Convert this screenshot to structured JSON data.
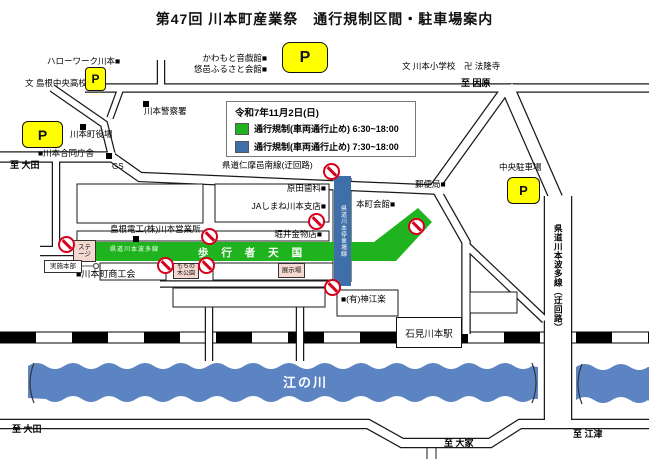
{
  "title": "第47回 川本町産業祭　通行規制区間・駐車場案内",
  "legend": {
    "date": "令和7年11月2日(日)",
    "items": [
      {
        "color": "#1fb41f",
        "label": "通行規制(車両通行止め) 6:30~18:00"
      },
      {
        "color": "#3f6fa8",
        "label": "通行規制(車両通行止め) 7:30~18:00"
      }
    ]
  },
  "green_zone": {
    "route_label": "県道川本波多線",
    "label": "歩 行 者 天 国"
  },
  "blue_road": {
    "label": "県道川本停車場線"
  },
  "bypass_road": {
    "label": "県道川本波多線（迂回路）"
  },
  "river": {
    "name": "江の川"
  },
  "station": {
    "name": "石見川本駅"
  },
  "boxes": [
    {
      "name": "stage-box",
      "text": "ステージ",
      "x": 73,
      "y": 240,
      "w": 23,
      "h": 22,
      "bg": "#f5d8cf",
      "fs": 6.5
    },
    {
      "name": "mochinoki-park-box",
      "text": "もちの木公園",
      "x": 173,
      "y": 263,
      "w": 26,
      "h": 16,
      "bg": "#f5d8cf",
      "fs": 6
    },
    {
      "name": "exhibition-box",
      "text": "展示場",
      "x": 278,
      "y": 263,
      "w": 27,
      "h": 15,
      "bg": "#f5d8cf",
      "fs": 6.5
    },
    {
      "name": "headquarters-box",
      "text": "実施本部",
      "x": 44,
      "y": 260,
      "w": 38,
      "h": 13,
      "bg": "#ffffff",
      "fs": 6.5
    }
  ],
  "parkings": [
    {
      "name": "parking-hellowork",
      "label": "P",
      "x": 85,
      "y": 67,
      "w": 21,
      "h": 24,
      "fs": 12,
      "r": 4
    },
    {
      "name": "parking-townhall",
      "label": "P",
      "x": 22,
      "y": 121,
      "w": 41,
      "h": 27,
      "fs": 14,
      "r": 6
    },
    {
      "name": "parking-kaikan",
      "label": "P",
      "x": 282,
      "y": 42,
      "w": 46,
      "h": 31,
      "fs": 16,
      "r": 8
    },
    {
      "name": "parking-chuo",
      "label": "P",
      "x": 507,
      "y": 177,
      "w": 33,
      "h": 27,
      "fs": 13,
      "r": 6
    }
  ],
  "labels": [
    {
      "name": "hellowork-label",
      "text": "ハローワーク川本■",
      "x": 47,
      "y": 57,
      "fs": 8.5
    },
    {
      "name": "chuo-highschool-label",
      "text": "文 島根中央高校",
      "x": 25,
      "y": 79,
      "fs": 8.5
    },
    {
      "name": "otogikan-label",
      "text": "かわもと音戯館■",
      "x": 267,
      "y": 54,
      "fs": 8.5,
      "r": true
    },
    {
      "name": "furusato-kaikan-label",
      "text": "悠邑ふるさと会館■",
      "x": 267,
      "y": 65,
      "fs": 8.5,
      "r": true
    },
    {
      "name": "elementary-temple-label",
      "text": "文 川本小学校　卍 法隆寺",
      "x": 402,
      "y": 62,
      "fs": 8.5
    },
    {
      "name": "to-inbara-label",
      "text": "至 因原",
      "x": 461,
      "y": 79,
      "fs": 9,
      "b": true
    },
    {
      "name": "police-label",
      "text": "川本警察署",
      "x": 144,
      "y": 107,
      "fs": 8.5
    },
    {
      "name": "townhall-label",
      "text": "川本町役場",
      "x": 70,
      "y": 130,
      "fs": 8.5
    },
    {
      "name": "godochosha-label",
      "text": "■川本合同庁舎",
      "x": 38,
      "y": 149,
      "fs": 8.5
    },
    {
      "name": "to-oda-north-label",
      "text": "至 大田",
      "x": 10,
      "y": 161,
      "fs": 9,
      "b": true
    },
    {
      "name": "gs-label",
      "text": "GS",
      "x": 112,
      "y": 163,
      "fs": 8
    },
    {
      "name": "nima-ohnan-route-label",
      "text": "県道仁摩邑南線(迂回路)",
      "x": 222,
      "y": 161,
      "fs": 8.5
    },
    {
      "name": "harada-dental-label",
      "text": "原田歯科■",
      "x": 326,
      "y": 184,
      "fs": 8.5,
      "r": true
    },
    {
      "name": "ja-kawamoto-label",
      "text": "JAしまね川本支店■",
      "x": 326,
      "y": 202,
      "fs": 8.5,
      "r": true
    },
    {
      "name": "shimane-denko-label",
      "text": "島根電工(株)川本営業所",
      "x": 110,
      "y": 225,
      "fs": 8.5
    },
    {
      "name": "horii-hardware-label",
      "text": "堀井金物店■",
      "x": 322,
      "y": 230,
      "fs": 8.5,
      "r": true
    },
    {
      "name": "post-office-label",
      "text": "郵便局■",
      "x": 415,
      "y": 180,
      "fs": 8.5
    },
    {
      "name": "honmachi-kaikan-label",
      "text": "本町会館■",
      "x": 356,
      "y": 200,
      "fs": 8.5
    },
    {
      "name": "chuo-parking-label",
      "text": "中央駐車場",
      "x": 499,
      "y": 163,
      "fs": 8.5
    },
    {
      "name": "shokokai-label",
      "text": "■川本町商工会",
      "x": 76,
      "y": 270,
      "fs": 9
    },
    {
      "name": "kanzeraku-label",
      "text": "■(有)神江楽",
      "x": 341,
      "y": 295,
      "fs": 8.5
    },
    {
      "name": "to-oda-south-label",
      "text": "至 大田",
      "x": 12,
      "y": 425,
      "fs": 9,
      "b": true
    },
    {
      "name": "to-oie-label",
      "text": "至 大家",
      "x": 444,
      "y": 439,
      "fs": 9,
      "b": true
    },
    {
      "name": "to-gotsu-label",
      "text": "至 江津",
      "x": 573,
      "y": 430,
      "fs": 9,
      "b": true
    }
  ],
  "markers": [
    {
      "name": "police-marker",
      "x": 143,
      "y": 101
    },
    {
      "name": "townhall-marker",
      "x": 80,
      "y": 124
    },
    {
      "name": "gs-marker",
      "x": 106,
      "y": 153
    },
    {
      "name": "shimane-denko-marker",
      "x": 133,
      "y": 236
    }
  ],
  "no_entry": [
    {
      "x": 332,
      "y": 172
    },
    {
      "x": 317,
      "y": 222
    },
    {
      "x": 210,
      "y": 237
    },
    {
      "x": 67,
      "y": 245
    },
    {
      "x": 166,
      "y": 266
    },
    {
      "x": 207,
      "y": 266
    },
    {
      "x": 333,
      "y": 288
    },
    {
      "x": 417,
      "y": 227
    }
  ]
}
